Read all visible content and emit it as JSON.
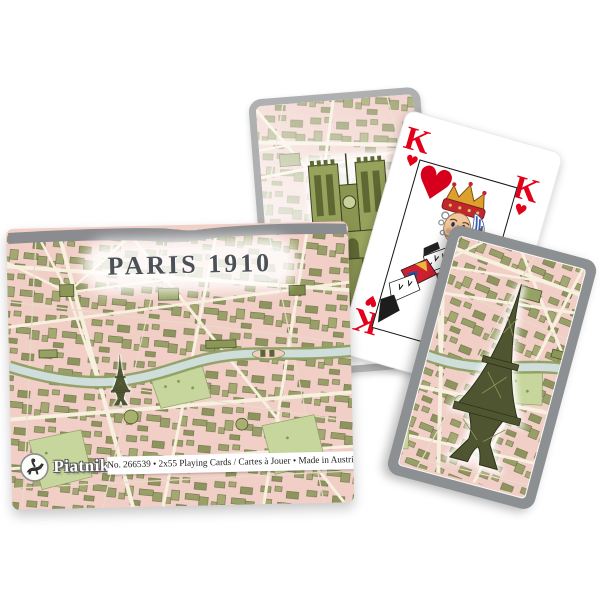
{
  "scene": {
    "description": "Product photo of Piatnik Paris 1910 double-deck playing cards: card box with vintage Paris map artwork, Notre-Dame card, King of Hearts card and map-back card with Eiffel Tower",
    "background_color": "#ffffff"
  },
  "box": {
    "title": "PARIS 1910",
    "brand": "Piatnik",
    "info_line": "No. 266539 • 2x55 Playing Cards / Cartes à Jouer • Made in Austria",
    "logo_icon": "piatnik-horse-rider-logo",
    "lid_color": "#8a8c8f"
  },
  "cards": {
    "king_of_hearts": {
      "rank": "K",
      "suit": "hearts",
      "suit_symbol": "♥",
      "index_corners": "four"
    },
    "notre_dame_card": {
      "illustration": "notre-dame-cathedral",
      "border_color": "#aeb0b2"
    },
    "eiffel_back_card": {
      "illustration": "eiffel-tower",
      "border_color": "#8d9092"
    }
  },
  "colors": {
    "heart_red": "#e2001a",
    "map_pink": "#f1cfc7",
    "map_street_cream": "#f7f0df",
    "map_building_olive": "#8a9757",
    "river_blue": "#cfdeda",
    "title_gray": "#4b5157",
    "card_border_gray": "#aeb0b2",
    "box_lid_gray": "#8a8c8f"
  }
}
